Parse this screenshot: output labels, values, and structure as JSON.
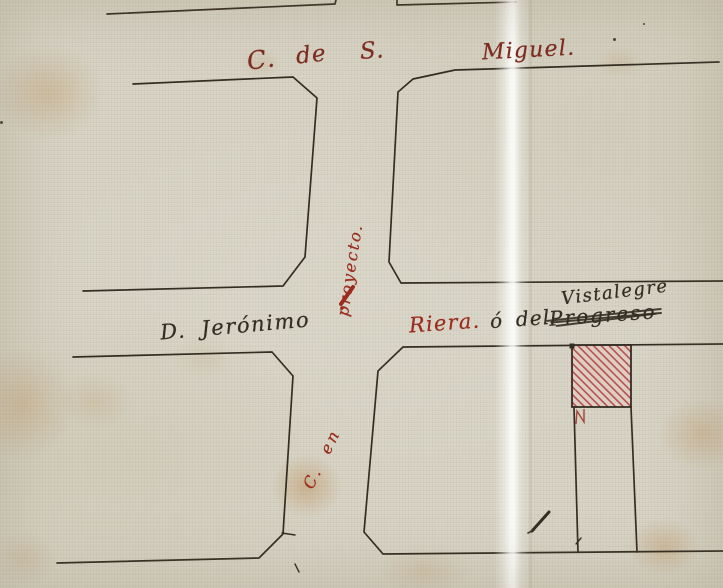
{
  "colors": {
    "paper": "#d7d3c5",
    "ink": "#342d23",
    "red-ink": "#9b2d1f",
    "red-label": "#7d2c20",
    "hatch-red": "#b04c48",
    "hatch-fill": "#e9cac2",
    "stain": "#b9894d"
  },
  "streets": {
    "san_miguel": {
      "parts": [
        "C.",
        "de",
        "S.",
        "Miguel."
      ]
    },
    "jeronimo": {
      "label": "D. Jerónimo"
    },
    "riera": {
      "name": "Riera.",
      "conjunction": "ó del",
      "struck_name": "Progreso",
      "new_name": "Vistalegre"
    },
    "projected": {
      "label_upper": "proyecto.",
      "label_lower": "C. en"
    }
  }
}
